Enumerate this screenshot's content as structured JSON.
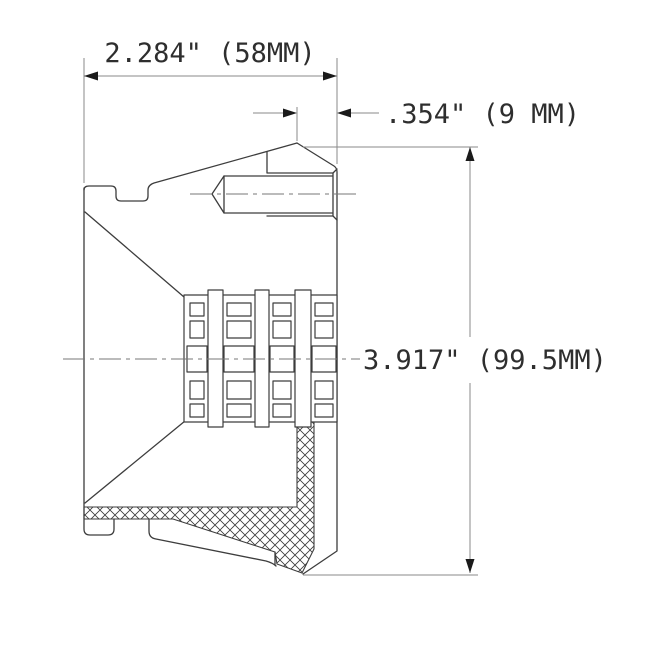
{
  "drawing": {
    "type": "technical-section-drawing",
    "dimensions": {
      "width": {
        "label": "2.284\" (58MM)"
      },
      "offset": {
        "label": ".354\" (9 MM)"
      },
      "height": {
        "label": "3.917\" (99.5MM)"
      }
    },
    "colors": {
      "background": "#ffffff",
      "part_line": "#3d3d3d",
      "dimension_line": "#8a8a8a",
      "arrow": "#1a1a1a",
      "text": "#2e2e2e",
      "hatch": "#3a3a3a"
    }
  }
}
